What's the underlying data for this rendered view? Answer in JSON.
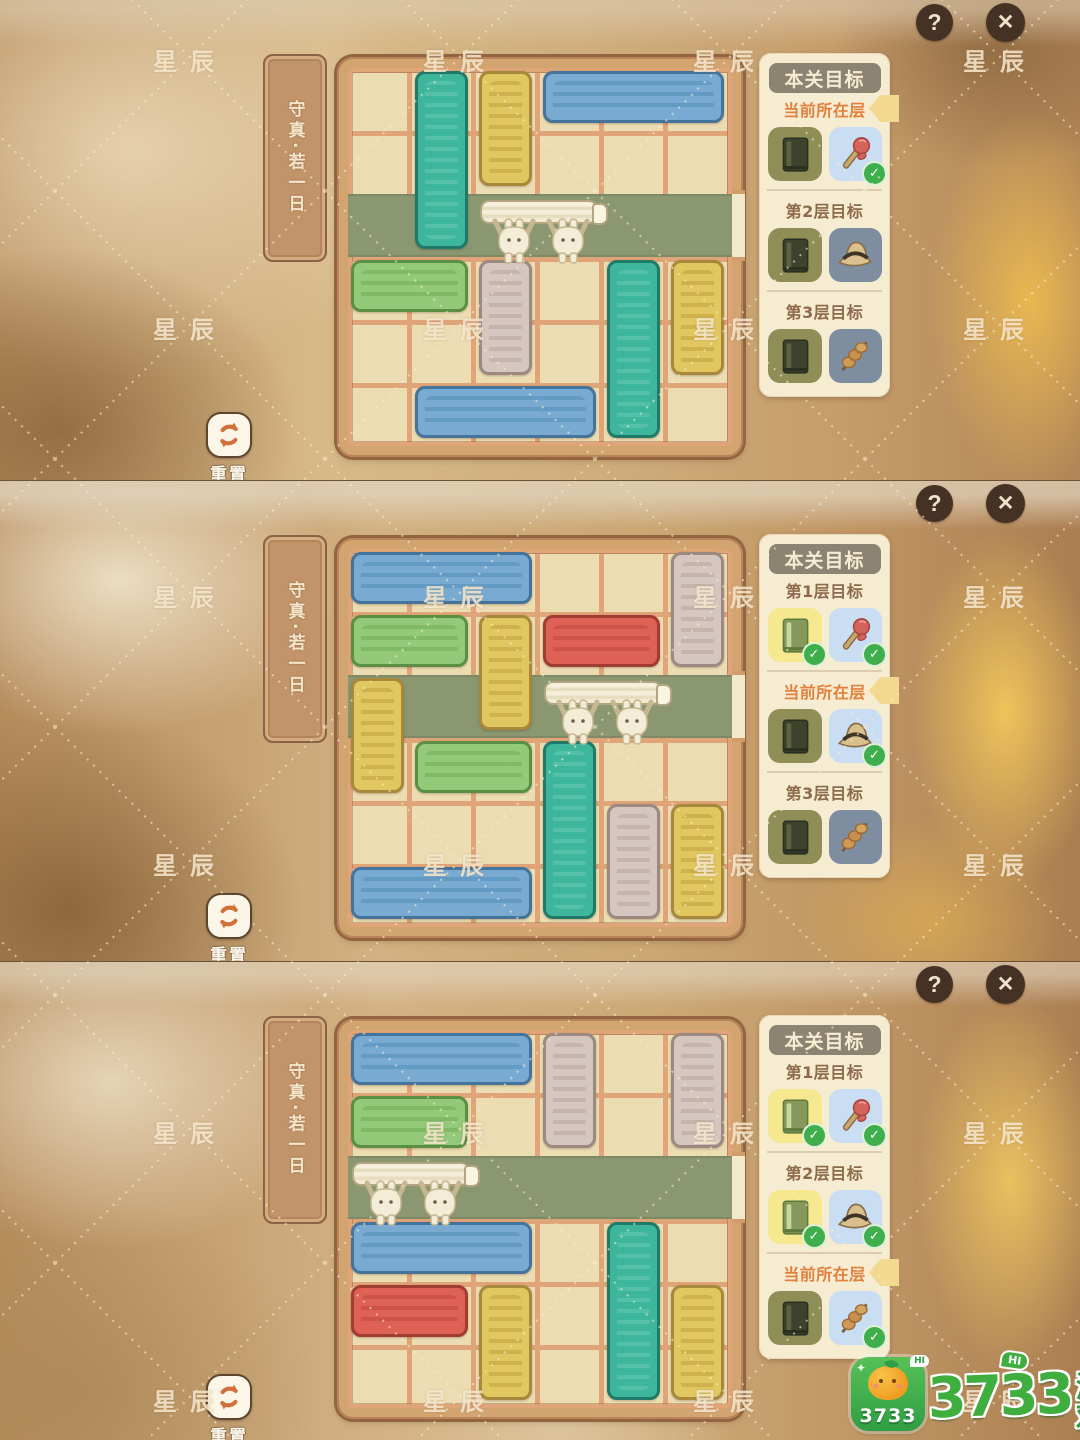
{
  "ui": {
    "help": "?",
    "close": "✕",
    "reset_label": "重置",
    "watermark": "星辰",
    "goal_header": "本关目标"
  },
  "colors": {
    "road": "#8a9770",
    "tile_floor": "#ecdcb2",
    "grout": "#dfa477",
    "frame": "#d2a470",
    "goal_panel_bg": "#f6ecd2",
    "current_label": "#e0813d",
    "layer_label": "#8d6a4b",
    "check_green": "#3fae4c",
    "blocks": {
      "teal": {
        "fill": "#3db69c",
        "edge": "#1f7a68",
        "inner": "#63c7ae"
      },
      "yellow": {
        "fill": "#e0c75f",
        "edge": "#a8893c",
        "inner": "#c3a33f"
      },
      "blue": {
        "fill": "#79abd2",
        "edge": "#44749c",
        "inner": "#5590bc"
      },
      "green": {
        "fill": "#93c979",
        "edge": "#5a8f44",
        "inner": "#74af58"
      },
      "pink": {
        "fill": "#d5c6bf",
        "edge": "#9c8a82",
        "inner": "#bba69f"
      },
      "red": {
        "fill": "#dd6154",
        "edge": "#a03c32",
        "inner": "#c44a3e"
      }
    },
    "book_tile": {
      "dark": {
        "bg": "#8f8e57",
        "book": "#3c422b",
        "spine": "#5d6340",
        "stroke": "#2a3020"
      },
      "yellow": {
        "bg": "#f5e88f",
        "book": "#86995a",
        "spine": "#c9d6a0",
        "stroke": "#5d7a3c"
      }
    },
    "item_tile": {
      "blue": "#c9def2",
      "slate": "#7e8da0"
    }
  },
  "panels": [
    {
      "title": "守真·若一日",
      "sidebar": {
        "rows": [
          {
            "label": "当前所在层",
            "current": true,
            "bookmark": true,
            "book": {
              "style": "dark",
              "check": false
            },
            "item": {
              "icon": "candy-hammer",
              "bg": "blue",
              "check": true
            }
          },
          {
            "label": "第2层目标",
            "current": false,
            "bookmark": false,
            "book": {
              "style": "dark",
              "check": false
            },
            "item": {
              "icon": "hat",
              "bg": "slate",
              "check": false
            }
          },
          {
            "label": "第3层目标",
            "current": false,
            "bookmark": false,
            "book": {
              "style": "dark",
              "check": false
            },
            "item": {
              "icon": "skewer",
              "bg": "slate",
              "check": false
            }
          }
        ]
      },
      "board": {
        "cols": 6,
        "rows": 6,
        "road_row": 2,
        "carrier": {
          "col": 2,
          "span": 2
        },
        "blocks": [
          {
            "color": "teal",
            "c": 1,
            "r": 0,
            "w": 1,
            "h": 3
          },
          {
            "color": "yellow",
            "c": 2,
            "r": 0,
            "w": 1,
            "h": 2
          },
          {
            "color": "blue",
            "c": 3,
            "r": 0,
            "w": 3,
            "h": 1
          },
          {
            "color": "green",
            "c": 0,
            "r": 3,
            "w": 2,
            "h": 1
          },
          {
            "color": "pink",
            "c": 2,
            "r": 3,
            "w": 1,
            "h": 2
          },
          {
            "color": "teal",
            "c": 4,
            "r": 3,
            "w": 1,
            "h": 3
          },
          {
            "color": "yellow",
            "c": 5,
            "r": 3,
            "w": 1,
            "h": 2
          },
          {
            "color": "blue",
            "c": 1,
            "r": 5,
            "w": 3,
            "h": 1
          }
        ]
      }
    },
    {
      "title": "守真·若一日",
      "sidebar": {
        "rows": [
          {
            "label": "第1层目标",
            "current": false,
            "bookmark": false,
            "book": {
              "style": "yellow",
              "check": true
            },
            "item": {
              "icon": "candy-hammer",
              "bg": "blue",
              "check": true
            }
          },
          {
            "label": "当前所在层",
            "current": true,
            "bookmark": true,
            "book": {
              "style": "dark",
              "check": false
            },
            "item": {
              "icon": "hat",
              "bg": "blue",
              "check": true
            }
          },
          {
            "label": "第3层目标",
            "current": false,
            "bookmark": false,
            "book": {
              "style": "dark",
              "check": false
            },
            "item": {
              "icon": "skewer",
              "bg": "slate",
              "check": false
            }
          }
        ]
      },
      "board": {
        "cols": 6,
        "rows": 6,
        "road_row": 2,
        "carrier": {
          "col": 3,
          "span": 2
        },
        "blocks": [
          {
            "color": "blue",
            "c": 0,
            "r": 0,
            "w": 3,
            "h": 1
          },
          {
            "color": "pink",
            "c": 5,
            "r": 0,
            "w": 1,
            "h": 2
          },
          {
            "color": "green",
            "c": 0,
            "r": 1,
            "w": 2,
            "h": 1
          },
          {
            "color": "yellow",
            "c": 2,
            "r": 1,
            "w": 1,
            "h": 2
          },
          {
            "color": "red",
            "c": 3,
            "r": 1,
            "w": 2,
            "h": 1
          },
          {
            "color": "yellow",
            "c": 0,
            "r": 2,
            "w": 1,
            "h": 2
          },
          {
            "color": "green",
            "c": 1,
            "r": 3,
            "w": 2,
            "h": 1
          },
          {
            "color": "teal",
            "c": 3,
            "r": 3,
            "w": 1,
            "h": 3
          },
          {
            "color": "pink",
            "c": 4,
            "r": 4,
            "w": 1,
            "h": 2
          },
          {
            "color": "yellow",
            "c": 5,
            "r": 4,
            "w": 1,
            "h": 2
          },
          {
            "color": "blue",
            "c": 0,
            "r": 5,
            "w": 3,
            "h": 1
          }
        ]
      }
    },
    {
      "title": "守真·若一日",
      "sidebar": {
        "rows": [
          {
            "label": "第1层目标",
            "current": false,
            "bookmark": false,
            "book": {
              "style": "yellow",
              "check": true
            },
            "item": {
              "icon": "candy-hammer",
              "bg": "blue",
              "check": true
            }
          },
          {
            "label": "第2层目标",
            "current": false,
            "bookmark": false,
            "book": {
              "style": "yellow",
              "check": true
            },
            "item": {
              "icon": "hat",
              "bg": "blue",
              "check": true
            }
          },
          {
            "label": "当前所在层",
            "current": true,
            "bookmark": true,
            "book": {
              "style": "dark",
              "check": false
            },
            "item": {
              "icon": "skewer",
              "bg": "blue",
              "check": true
            }
          }
        ]
      },
      "board": {
        "cols": 6,
        "rows": 6,
        "road_row": 2,
        "carrier": {
          "col": 0,
          "span": 2
        },
        "blocks": [
          {
            "color": "blue",
            "c": 0,
            "r": 0,
            "w": 3,
            "h": 1
          },
          {
            "color": "pink",
            "c": 3,
            "r": 0,
            "w": 1,
            "h": 2
          },
          {
            "color": "pink",
            "c": 5,
            "r": 0,
            "w": 1,
            "h": 2
          },
          {
            "color": "green",
            "c": 0,
            "r": 1,
            "w": 2,
            "h": 1
          },
          {
            "color": "blue",
            "c": 0,
            "r": 3,
            "w": 3,
            "h": 1
          },
          {
            "color": "teal",
            "c": 4,
            "r": 3,
            "w": 1,
            "h": 3
          },
          {
            "color": "red",
            "c": 0,
            "r": 4,
            "w": 2,
            "h": 1
          },
          {
            "color": "yellow",
            "c": 2,
            "r": 4,
            "w": 1,
            "h": 2
          },
          {
            "color": "yellow",
            "c": 5,
            "r": 4,
            "w": 1,
            "h": 2
          }
        ]
      }
    }
  ],
  "logo": {
    "app_text": "3733",
    "app_bubble": "HI",
    "wordmark_number": "3733",
    "wordmark_suffix": "游戏",
    "wordmark_domain": ".com",
    "wordmark_bubble": "HI",
    "brand_green": "#3fae3f"
  }
}
